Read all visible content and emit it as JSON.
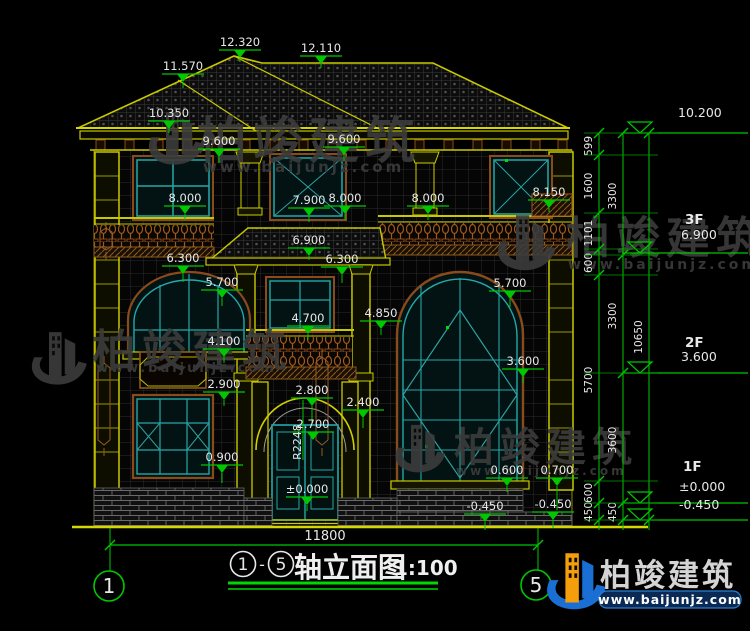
{
  "drawing": {
    "title": {
      "axis_start": "1",
      "axis_end": "5",
      "dash": "-",
      "name": "轴立面图",
      "scale": "1:100"
    },
    "bottom_dimension": {
      "value": "11800",
      "x1": 110,
      "x2": 538,
      "y": 545,
      "tx": 325,
      "ty": 540
    },
    "axis_bubbles": [
      {
        "label": "1",
        "cx": 109,
        "cy": 586,
        "r": 15,
        "lx": 110
      },
      {
        "label": "5",
        "cx": 536,
        "cy": 585,
        "r": 15,
        "lx": 538
      }
    ],
    "elevation_marks": [
      {
        "value": "12.320",
        "x": 240,
        "y": 46,
        "drop": 4
      },
      {
        "value": "12.110",
        "x": 321,
        "y": 52,
        "drop": 4
      },
      {
        "value": "11.570",
        "x": 183,
        "y": 70,
        "drop": 6
      },
      {
        "value": "10.350",
        "x": 169,
        "y": 117,
        "drop": 4
      },
      {
        "value": "9.600",
        "x": 219,
        "y": 145,
        "drop": 6
      },
      {
        "value": "9.600",
        "x": 344,
        "y": 143,
        "drop": 6
      },
      {
        "value": "8.000",
        "x": 185,
        "y": 202,
        "drop": 6
      },
      {
        "value": "7.900",
        "x": 309,
        "y": 204,
        "drop": 6
      },
      {
        "value": "8.000",
        "x": 345,
        "y": 202,
        "drop": 6
      },
      {
        "value": "8.000",
        "x": 428,
        "y": 202,
        "drop": 6
      },
      {
        "value": "8.150",
        "x": 549,
        "y": 196,
        "drop": 4
      },
      {
        "value": "6.900",
        "x": 309,
        "y": 244,
        "drop": 4
      },
      {
        "value": "6.300",
        "x": 183,
        "y": 262,
        "drop": 8
      },
      {
        "value": "6.300",
        "x": 342,
        "y": 263,
        "drop": 8
      },
      {
        "value": "5.700",
        "x": 222,
        "y": 286,
        "drop": 8
      },
      {
        "value": "5.700",
        "x": 510,
        "y": 287,
        "drop": 8
      },
      {
        "value": "4.850",
        "x": 381,
        "y": 317,
        "drop": 6
      },
      {
        "value": "4.700",
        "x": 308,
        "y": 322,
        "drop": 6
      },
      {
        "value": "4.100",
        "x": 224,
        "y": 345,
        "drop": 6
      },
      {
        "value": "3.600",
        "x": 523,
        "y": 365,
        "drop": 6
      },
      {
        "value": "2.900",
        "x": 224,
        "y": 388,
        "drop": 6
      },
      {
        "value": "2.800",
        "x": 312,
        "y": 394,
        "drop": 18
      },
      {
        "value": "2.400",
        "x": 363,
        "y": 406,
        "drop": 10
      },
      {
        "value": "2.700",
        "x": 313,
        "y": 428,
        "drop": 0
      },
      {
        "value": "0.900",
        "x": 222,
        "y": 461,
        "drop": 10
      },
      {
        "value": "0.600",
        "x": 507,
        "y": 474,
        "drop": 6
      },
      {
        "value": "0.700",
        "x": 557,
        "y": 474,
        "drop": 24
      },
      {
        "value": "±0.000",
        "x": 307,
        "y": 493,
        "drop": 6
      },
      {
        "value": "-0.450",
        "x": 485,
        "y": 510,
        "drop": 8
      },
      {
        "value": "-0.450",
        "x": 553,
        "y": 508,
        "drop": 8
      }
    ],
    "radius_label": {
      "value": "R2248",
      "x": 301,
      "y": 442
    },
    "right_levels": [
      {
        "floor": "",
        "value": "10.200",
        "vx": 682,
        "fy": 0,
        "vy": 117,
        "line_y": 133
      },
      {
        "floor": "3F",
        "value": "6.900",
        "vx": 685,
        "fy": 224,
        "vy": 239,
        "line_y": 253
      },
      {
        "floor": "2F",
        "value": "3.600",
        "vx": 685,
        "fy": 347,
        "vy": 361,
        "line_y": 373
      },
      {
        "floor": "1F",
        "value": "±0.000",
        "vx": 683,
        "fy": 471,
        "vy": 491,
        "line_y": 503
      },
      {
        "floor": "",
        "value": "-0.450",
        "vx": 683,
        "fy": 0,
        "vy": 509,
        "line_y": 520
      }
    ],
    "dim_chains": [
      {
        "x": 599,
        "ticks": [
          133,
          155,
          213,
          249,
          275,
          481,
          503,
          520
        ],
        "labels": [
          {
            "value": "599",
            "y": 146
          },
          {
            "value": "1600",
            "y": 186
          },
          {
            "value": "1101",
            "y": 233
          },
          {
            "value": "600",
            "y": 263
          },
          {
            "value": "5700",
            "y": 380
          },
          {
            "value": "600",
            "y": 493
          },
          {
            "value": "450",
            "y": 512
          }
        ]
      },
      {
        "x": 623,
        "ticks": [
          133,
          255,
          373,
          503,
          520
        ],
        "labels": [
          {
            "value": "3300",
            "y": 196
          },
          {
            "value": "3300",
            "y": 316
          },
          {
            "value": "3600",
            "y": 440
          },
          {
            "value": "450",
            "y": 512
          }
        ]
      },
      {
        "x": 649,
        "ticks": [
          133,
          520
        ],
        "labels": [
          {
            "value": "10650",
            "y": 337
          }
        ]
      }
    ],
    "watermark": {
      "text": "柏竣建筑",
      "url": "www.baijunjz.com",
      "instances": [
        {
          "icon": [
            145,
            110,
            1.05
          ],
          "txt": [
            197,
            158,
            50
          ],
          "url": [
            203,
            172,
            15
          ]
        },
        {
          "icon": [
            28,
            330,
            1.05
          ],
          "txt": [
            92,
            366,
            44
          ],
          "url": [
            96,
            372,
            13
          ]
        },
        {
          "icon": [
            494,
            213,
            1.1
          ],
          "txt": [
            566,
            253,
            44
          ],
          "url": [
            568,
            269,
            14
          ]
        },
        {
          "icon": [
            392,
            423,
            0.95
          ],
          "txt": [
            454,
            461,
            40
          ],
          "url": [
            456,
            475,
            12
          ]
        }
      ]
    },
    "logo": {
      "text": "柏竣建筑",
      "url": "www.baijunjz.com"
    },
    "colors": {
      "line_yellow": "#c9c900",
      "line_green": "#00c800",
      "line_teal": "#25a8a8",
      "trim_brown": "#9a5a20",
      "text_white": "#e8e8e8",
      "watermark_gray": "#3c3c3c",
      "logo_blue": "#1a6fd4",
      "logo_orange": "#f59e0b"
    }
  }
}
